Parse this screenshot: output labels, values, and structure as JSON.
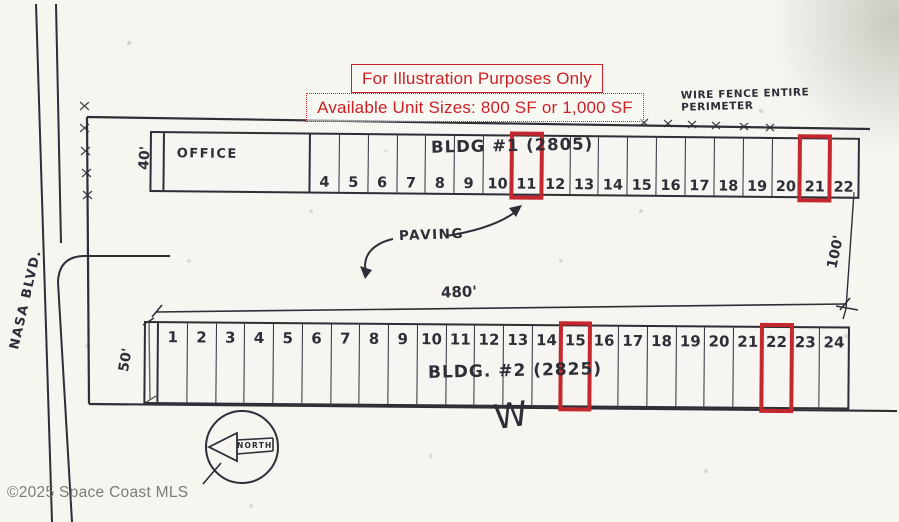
{
  "notices": {
    "illustration": "For Illustration Purposes Only",
    "unit_sizes": "Available Unit Sizes: 800 SF or 1,000 SF"
  },
  "site": {
    "street": "NASA BLVD.",
    "fence_note_line1": "WIRE FENCE ENTIRE",
    "fence_note_line2": "PERIMETER",
    "paving_label": "PAVING",
    "north_label": "NORTH",
    "w_mark": "W"
  },
  "dimensions": {
    "bldg1_depth": "40'",
    "bldg2_depth": "50'",
    "bldg2_length": "480'",
    "yard_depth": "100'"
  },
  "buildings": [
    {
      "label": "BLDG #1",
      "address": "(2805)",
      "office": "OFFICE",
      "units": [
        "4",
        "5",
        "6",
        "7",
        "8",
        "9",
        "10",
        "11",
        "12",
        "13",
        "14",
        "15",
        "16",
        "17",
        "18",
        "19",
        "20",
        "21",
        "22"
      ],
      "highlighted": [
        "11",
        "21"
      ]
    },
    {
      "label": "BLDG. #2",
      "address": "(2825)",
      "units": [
        "1",
        "2",
        "3",
        "4",
        "5",
        "6",
        "7",
        "8",
        "9",
        "10",
        "11",
        "12",
        "13",
        "14",
        "15",
        "16",
        "17",
        "18",
        "19",
        "20",
        "21",
        "22",
        "23",
        "24"
      ],
      "highlighted": [
        "15",
        "22"
      ]
    }
  ],
  "footer": {
    "copyright": "©2025 Space Coast MLS"
  },
  "colors": {
    "ink": "#2e2e38",
    "red": "#c4272d",
    "notice_red": "#cb2026"
  }
}
